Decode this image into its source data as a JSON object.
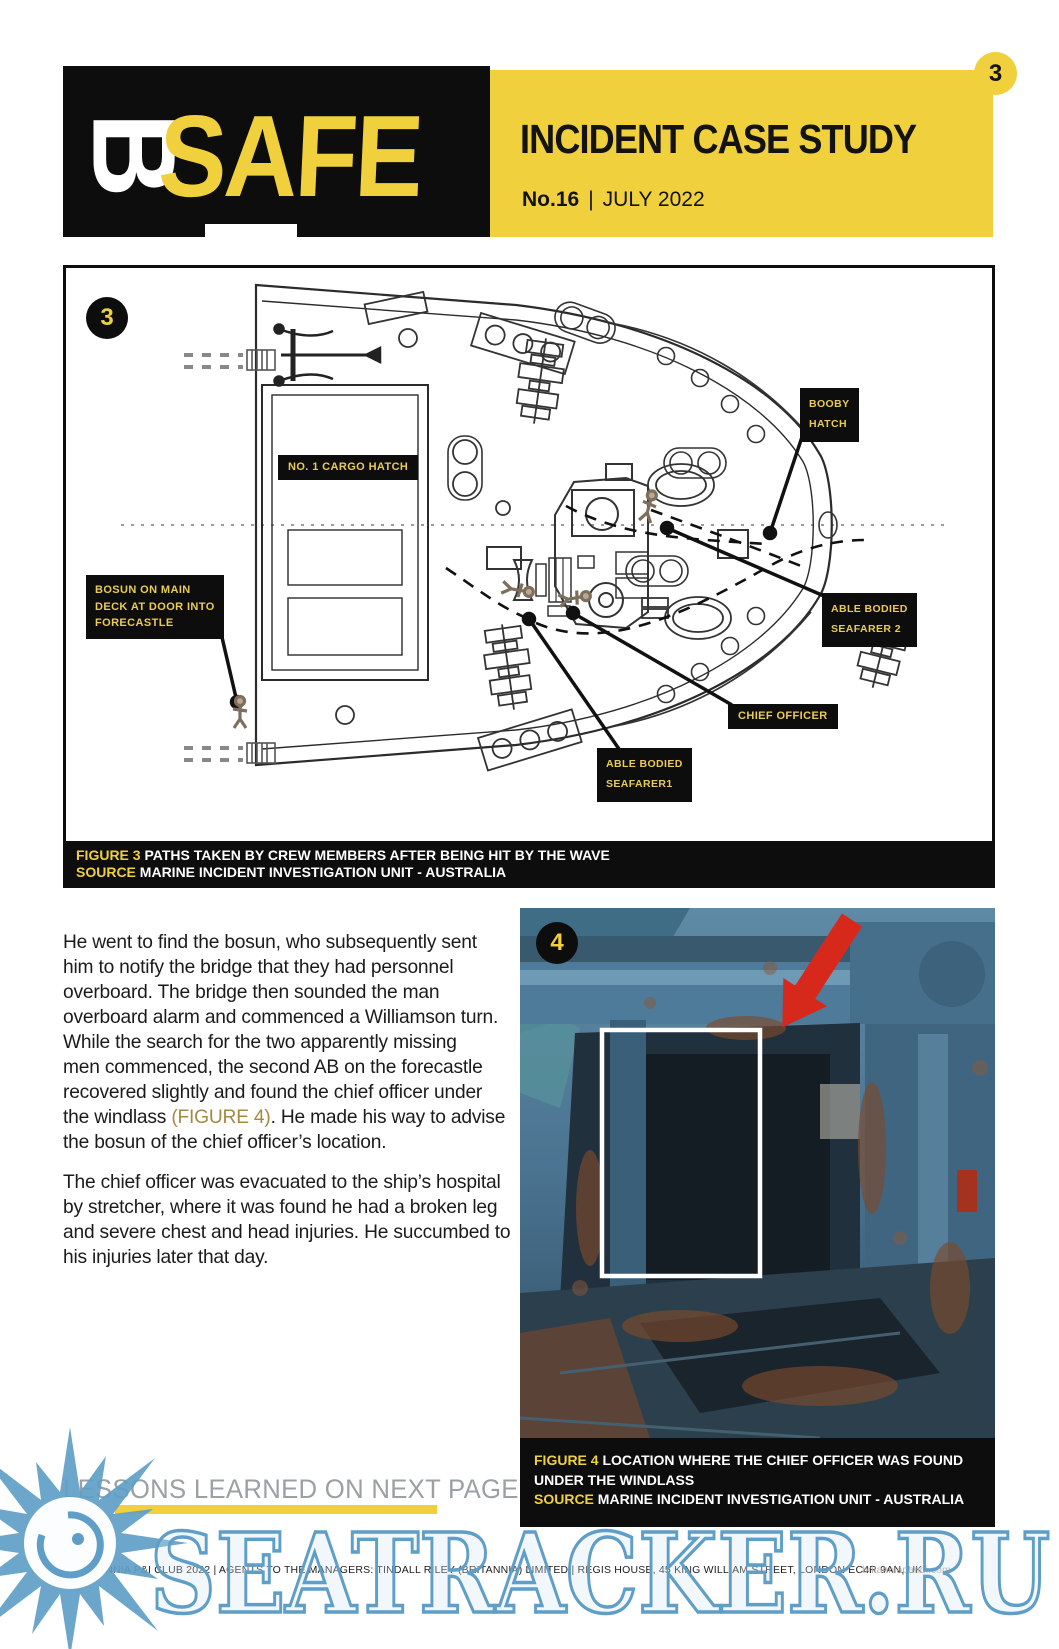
{
  "page_number": "3",
  "header": {
    "logo_b": "B",
    "logo_safe": "SAFE",
    "title": "INCIDENT CASE STUDY",
    "issue_no": "No.16",
    "divider": "|",
    "issue_date": "JULY 2022"
  },
  "figure3": {
    "badge": "3",
    "diagram_labels": {
      "booby_hatch_l1": "BOOBY",
      "booby_hatch_l2": "HATCH",
      "cargo_hatch": "NO. 1 CARGO HATCH",
      "bosun_l1": "BOSUN ON MAIN",
      "bosun_l2": "DECK AT DOOR INTO",
      "bosun_l3": "FORECASTLE",
      "seafarer2_l1": "ABLE BODIED",
      "seafarer2_l2": "SEAFARER 2",
      "chief_officer": "CHIEF OFFICER",
      "seafarer1_l1": "ABLE BODIED",
      "seafarer1_l2": "SEAFARER1"
    },
    "caption": {
      "figure_label": "FIGURE 3",
      "figure_text": "PATHS TAKEN BY CREW MEMBERS AFTER BEING HIT BY THE WAVE",
      "source_label": "SOURCE",
      "source_text": "MARINE INCIDENT INVESTIGATION UNIT - AUSTRALIA"
    }
  },
  "body": {
    "p1_l1": "He went to find the bosun, who subsequently sent",
    "p1_l2": "him to notify the bridge that they had personnel",
    "p1_l3": "overboard. The bridge then sounded the man",
    "p1_l4": "overboard alarm and commenced a Williamson turn.",
    "p1_l5": "While the search for the two apparently missing",
    "p1_l6": "men commenced, the second AB on the forecastle",
    "p1_l7": "recovered slightly and found the chief officer under",
    "p1_l8_pre": "the windlass ",
    "p1_l8_ref": "(FIGURE 4)",
    "p1_l8_post": ". He made his way to advise",
    "p1_l9": "the bosun of the chief officer’s location.",
    "p2_l1": "The chief officer was evacuated to the ship’s hospital",
    "p2_l2": "by stretcher, where it was found he had a broken leg",
    "p2_l3": "and severe chest and head injuries. He succumbed to",
    "p2_l4": "his injuries later that day."
  },
  "figure4": {
    "badge": "4",
    "caption": {
      "figure_label": "FIGURE 4",
      "figure_text_l1": "LOCATION WHERE THE CHIEF OFFICER WAS FOUND",
      "figure_text_l2": "UNDER THE WINDLASS",
      "source_label": "SOURCE",
      "source_text": "MARINE INCIDENT INVESTIGATION UNIT - AUSTRALIA"
    }
  },
  "lessons_banner": "LESSONS LEARNED ON NEXT PAGE",
  "footer": {
    "copyright": "© BRITANNIA P&I CLUB 2022  |  AGENTS TO THE MANAGERS: TINDALL RILEY (BRITANNIA) LIMITED  |  REGIS HOUSE, 45 KING WILLIAM STREET, LONDON EC4R 9AN, UK",
    "website": "britanniapandi.com"
  },
  "watermark_text": "SEATRACKER.RU",
  "colors": {
    "brand_yellow": "#F0D03C",
    "label_yellow": "#E9CC55",
    "figure_ref_gold": "#A58942",
    "lessons_gray": "#9AA0A4",
    "watermark_blue": "#5F9EC6",
    "arrow_red": "#D7281C"
  }
}
